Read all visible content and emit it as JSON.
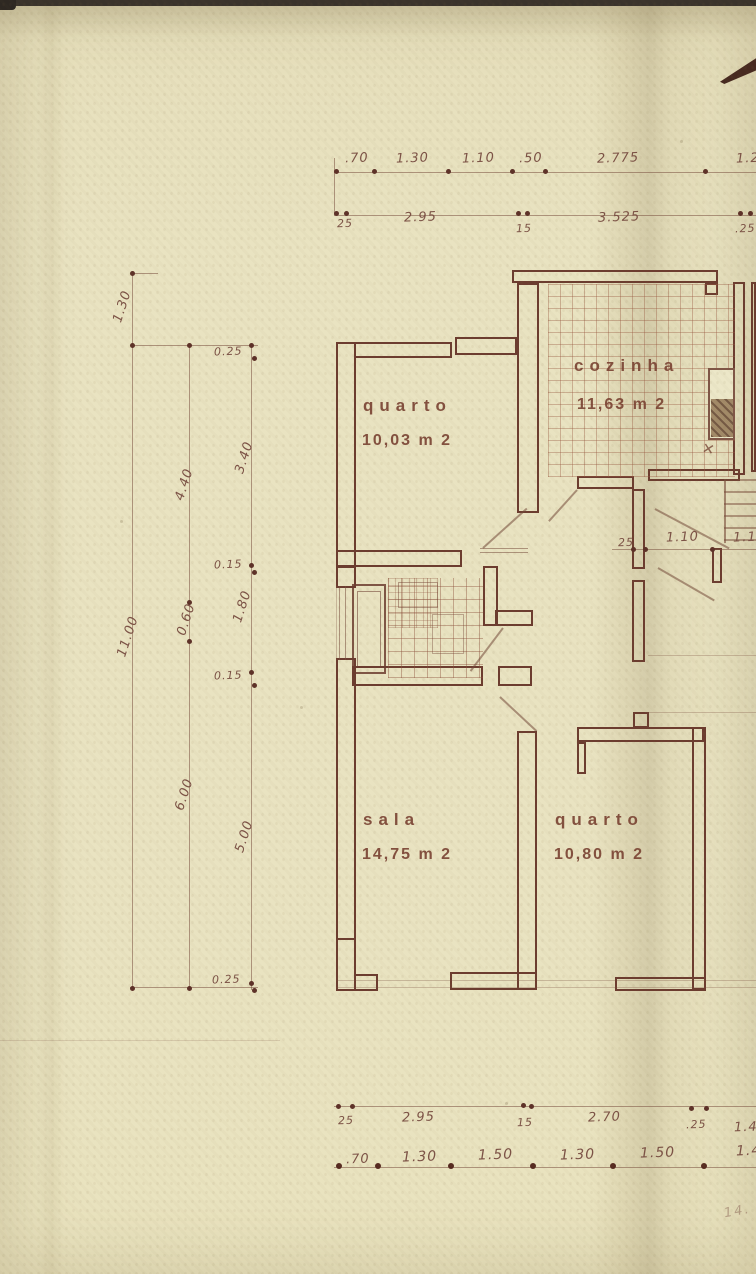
{
  "document": {
    "kind": "scanned architectural floor plan",
    "language": "pt"
  },
  "colors": {
    "paper": "#e9e3c1",
    "wall_ink": "#6c3c2f",
    "dimension_ink": "#7c5246",
    "scan_top_edge": "#3a332b",
    "corner_mark": "#472a20",
    "sink_fill": "#a28a68"
  },
  "icons": {
    "fixture_cross": "✕"
  },
  "rooms": [
    {
      "id": "quarto-1",
      "label": "quarto",
      "area": "10,03 m 2"
    },
    {
      "id": "cozinha",
      "label": "cozinha",
      "area": "11,63 m 2"
    },
    {
      "id": "sala",
      "label": "sala",
      "area": "14,75 m 2"
    },
    {
      "id": "quarto-2",
      "label": "quarto",
      "area": "10,80 m 2"
    }
  ],
  "dimensions": {
    "top_row_upper": [
      ".70",
      "1.30",
      "1.10",
      ".50",
      "2.775",
      "1.25"
    ],
    "top_row_lower": [
      "25",
      "2.95",
      "15",
      "3.525",
      ".25"
    ],
    "left_outer_top": "1.30",
    "left_outer_total": "11.00",
    "left_middle": [
      "4.40",
      "0.60",
      "6.00"
    ],
    "left_inner": [
      "0.25",
      "3.40",
      "0.15",
      "1.80",
      "0.15",
      "5.00",
      "0.25"
    ],
    "hall_row": [
      "25",
      "1.10",
      "1.13"
    ],
    "bottom_row_upper": [
      "25",
      "2.95",
      "15",
      "2.70",
      ".25",
      "1.4"
    ],
    "bottom_row_lower": [
      ".70",
      "1.30",
      "1.50",
      "1.30",
      "1.50",
      "1.4"
    ],
    "corner_note": "14."
  }
}
